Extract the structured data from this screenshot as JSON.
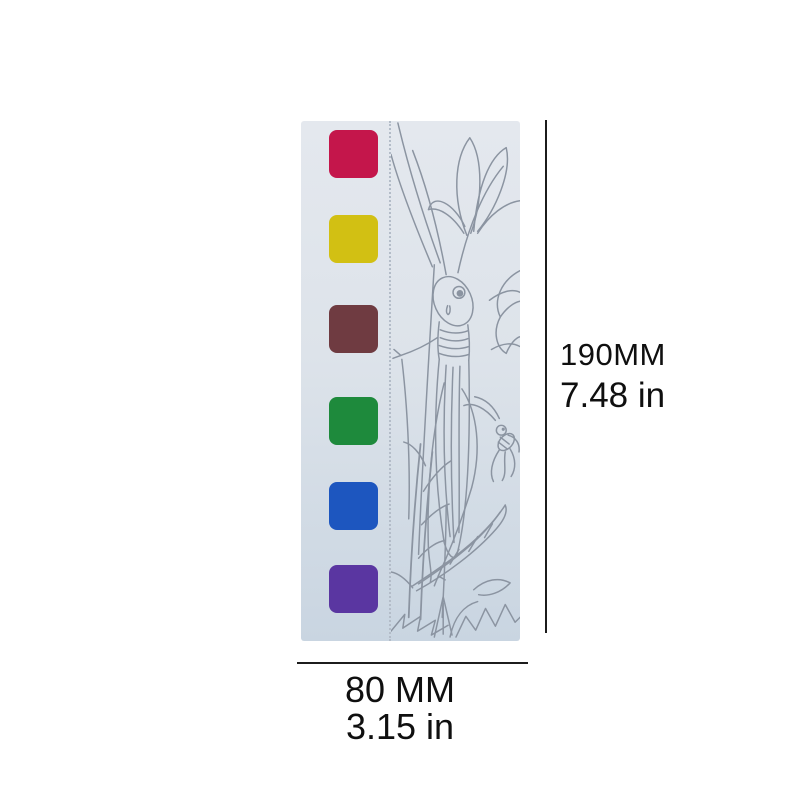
{
  "product_card": {
    "description": "Pocket watercolor paint card with grasshopper coloring line art",
    "background_top": "#e4e8ee",
    "background_mid": "#dde3ea",
    "background_bottom": "#c9d5e1",
    "line_art_color": "#8b94a1",
    "perforation_color": "#b3bcc8",
    "palette": [
      {
        "name": "crimson",
        "hex": "#c4164b"
      },
      {
        "name": "yellow",
        "hex": "#d2c013"
      },
      {
        "name": "brown",
        "hex": "#6f3b41"
      },
      {
        "name": "green",
        "hex": "#1e8a3c"
      },
      {
        "name": "blue",
        "hex": "#1d56bf"
      },
      {
        "name": "purple",
        "hex": "#5a36a1"
      }
    ],
    "illustration": "grasshopper-and-cricket-with-plants"
  },
  "dimensions": {
    "height_metric": "190MM",
    "height_imperial": "7.48 in",
    "width_metric": "80 MM",
    "width_imperial": "3.15 in",
    "line_color": "#1c1c1c",
    "text_color": "#0f0f0f"
  }
}
